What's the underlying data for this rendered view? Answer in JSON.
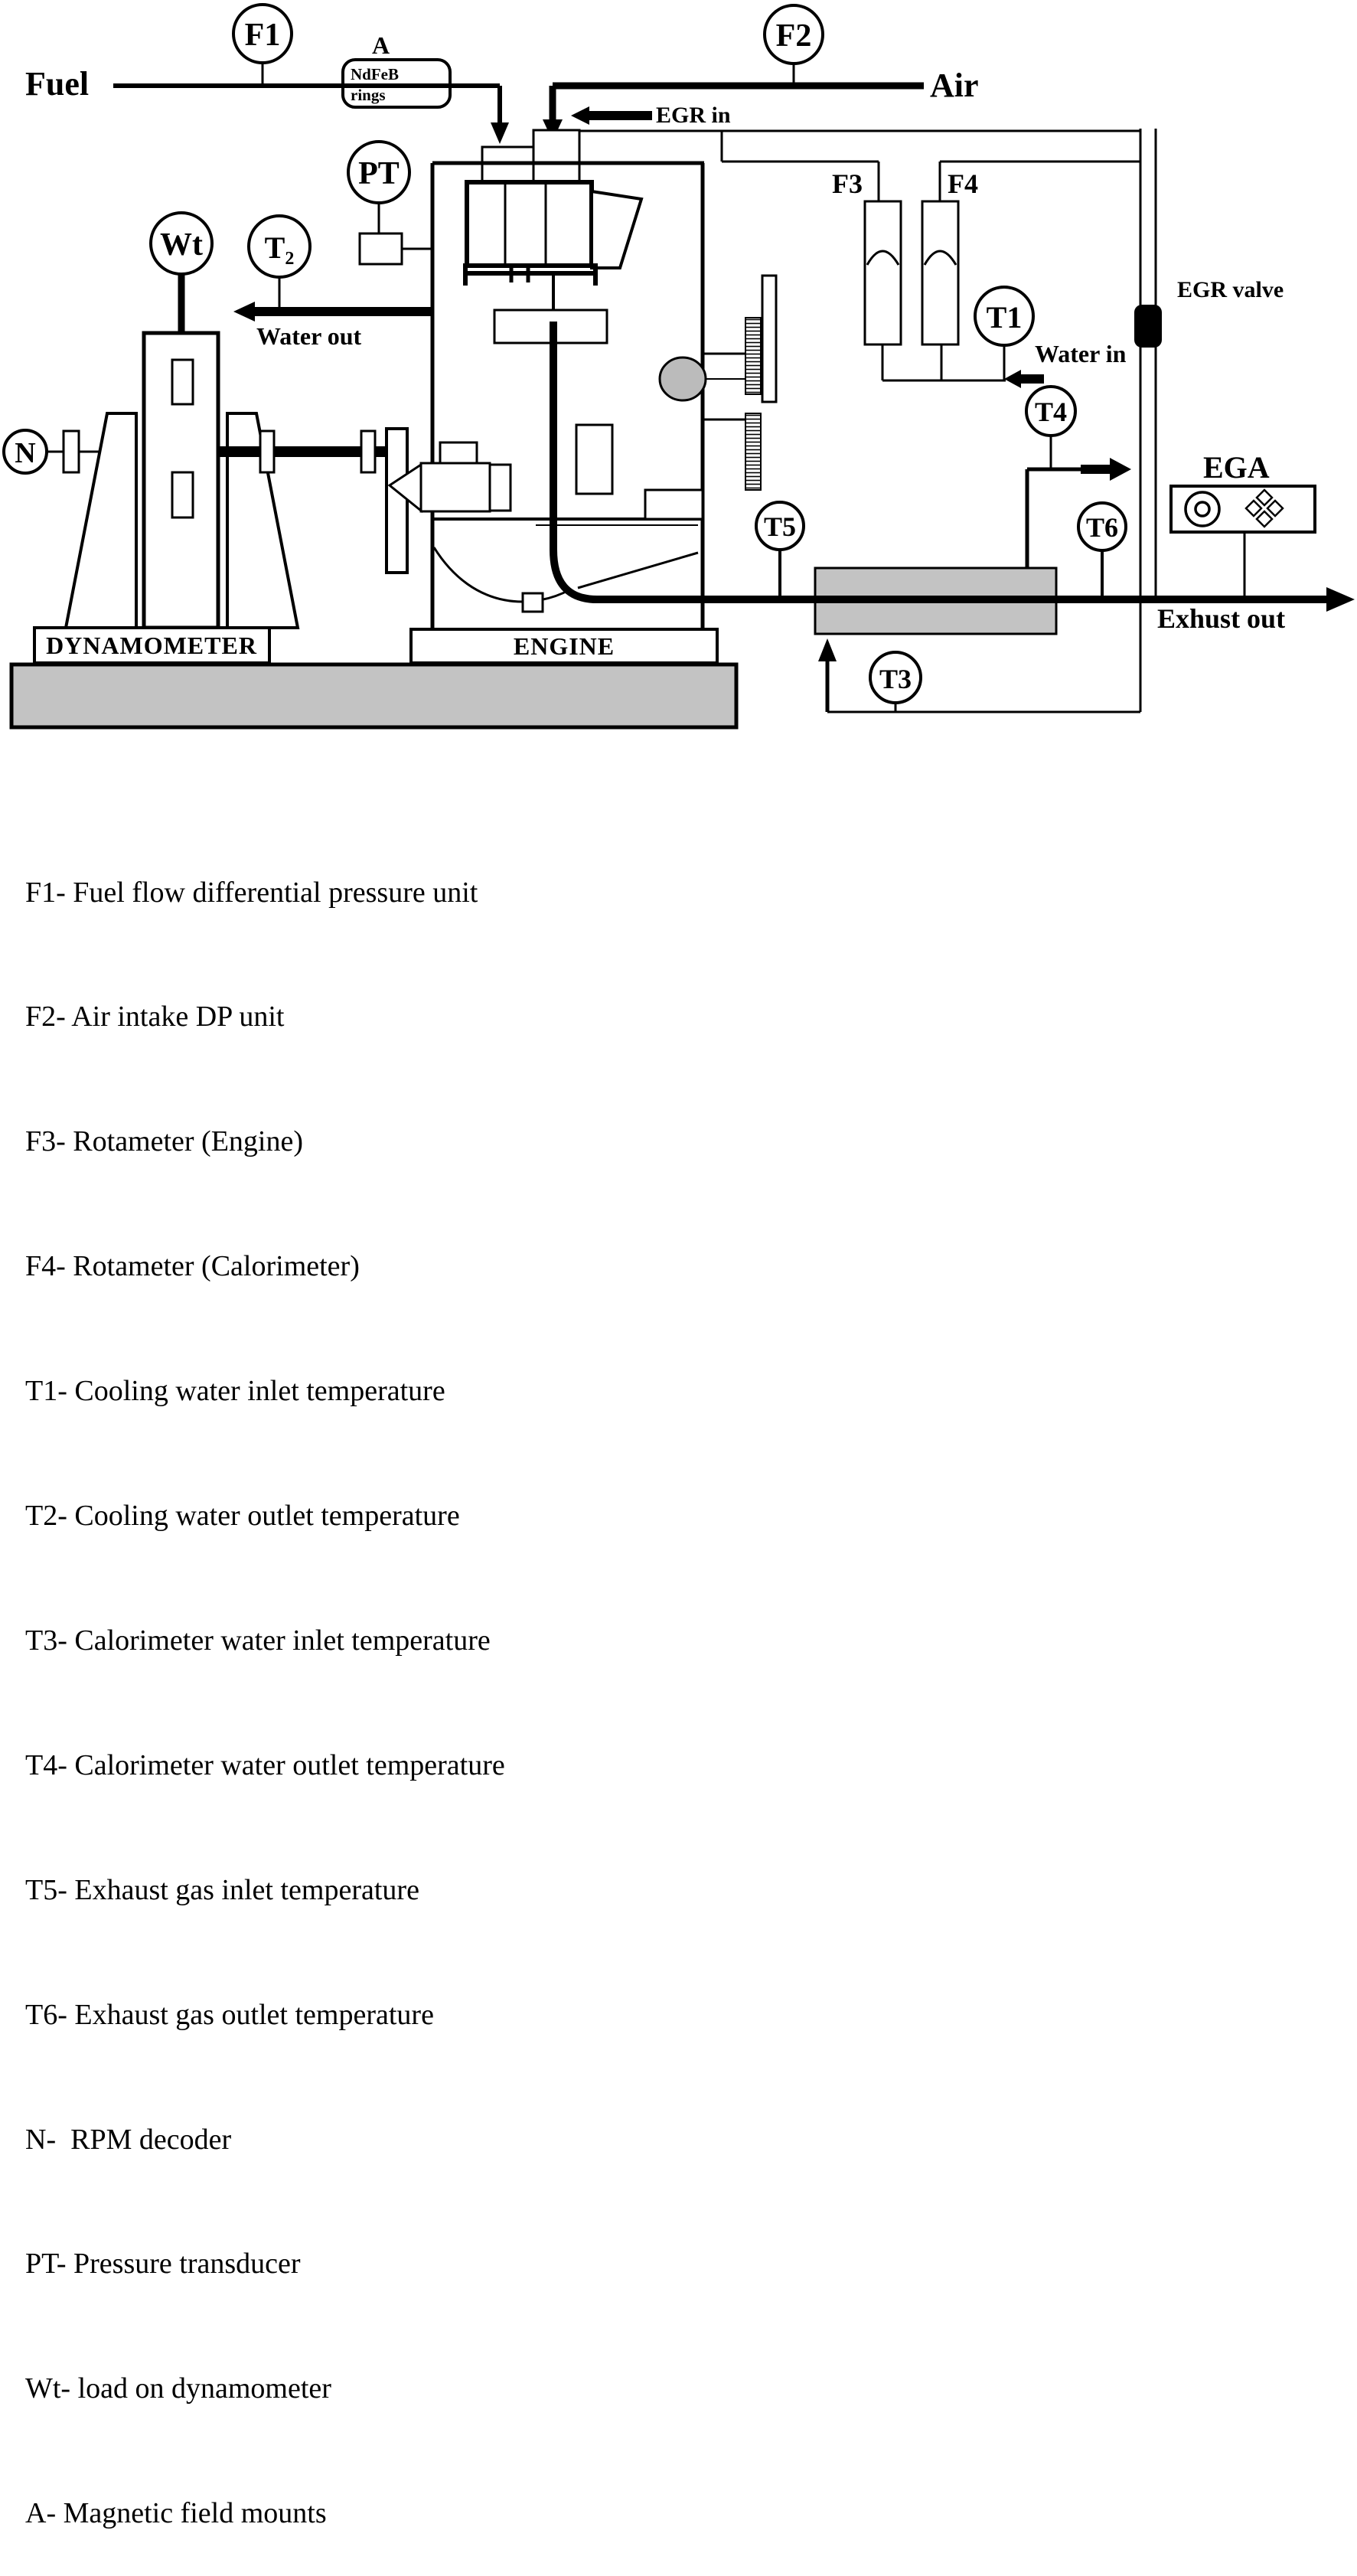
{
  "sensors": {
    "f1": "F1",
    "f2": "F2",
    "pt": "PT",
    "wt": "Wt",
    "t2": "T₂",
    "n": "N",
    "t1": "T1",
    "t3": "T3",
    "t4": "T4",
    "t5": "T5",
    "t6": "T6"
  },
  "labels": {
    "fuel": "Fuel",
    "air": "Air",
    "egr_in": "EGR in",
    "a_mount": "A",
    "ndfeb": "NdFeB",
    "rings": "rings",
    "water_out": "Water out",
    "water_in": "Water in",
    "egr_valve": "EGR valve",
    "ega": "EGA",
    "exhaust_out": "Exhust out",
    "f3": "F3",
    "f4": "F4",
    "dynamometer": "DYNAMOMETER",
    "engine": "ENGINE"
  },
  "colors": {
    "slab_gray": "#c3c3c3",
    "line_black": "#000000"
  },
  "legend": {
    "items": [
      "F1- Fuel flow differential pressure unit",
      "F2- Air intake DP unit",
      "F3- Rotameter (Engine)",
      "F4- Rotameter (Calorimeter)",
      "T1- Cooling water inlet temperature",
      "T2- Cooling water outlet temperature",
      "T3- Calorimeter water inlet temperature",
      "T4- Calorimeter water outlet temperature",
      "T5- Exhaust gas inlet temperature",
      "T6- Exhaust gas outlet temperature",
      "N-  RPM decoder",
      "PT- Pressure transducer",
      "Wt- load on dynamometer",
      "A- Magnetic field mounts"
    ]
  }
}
